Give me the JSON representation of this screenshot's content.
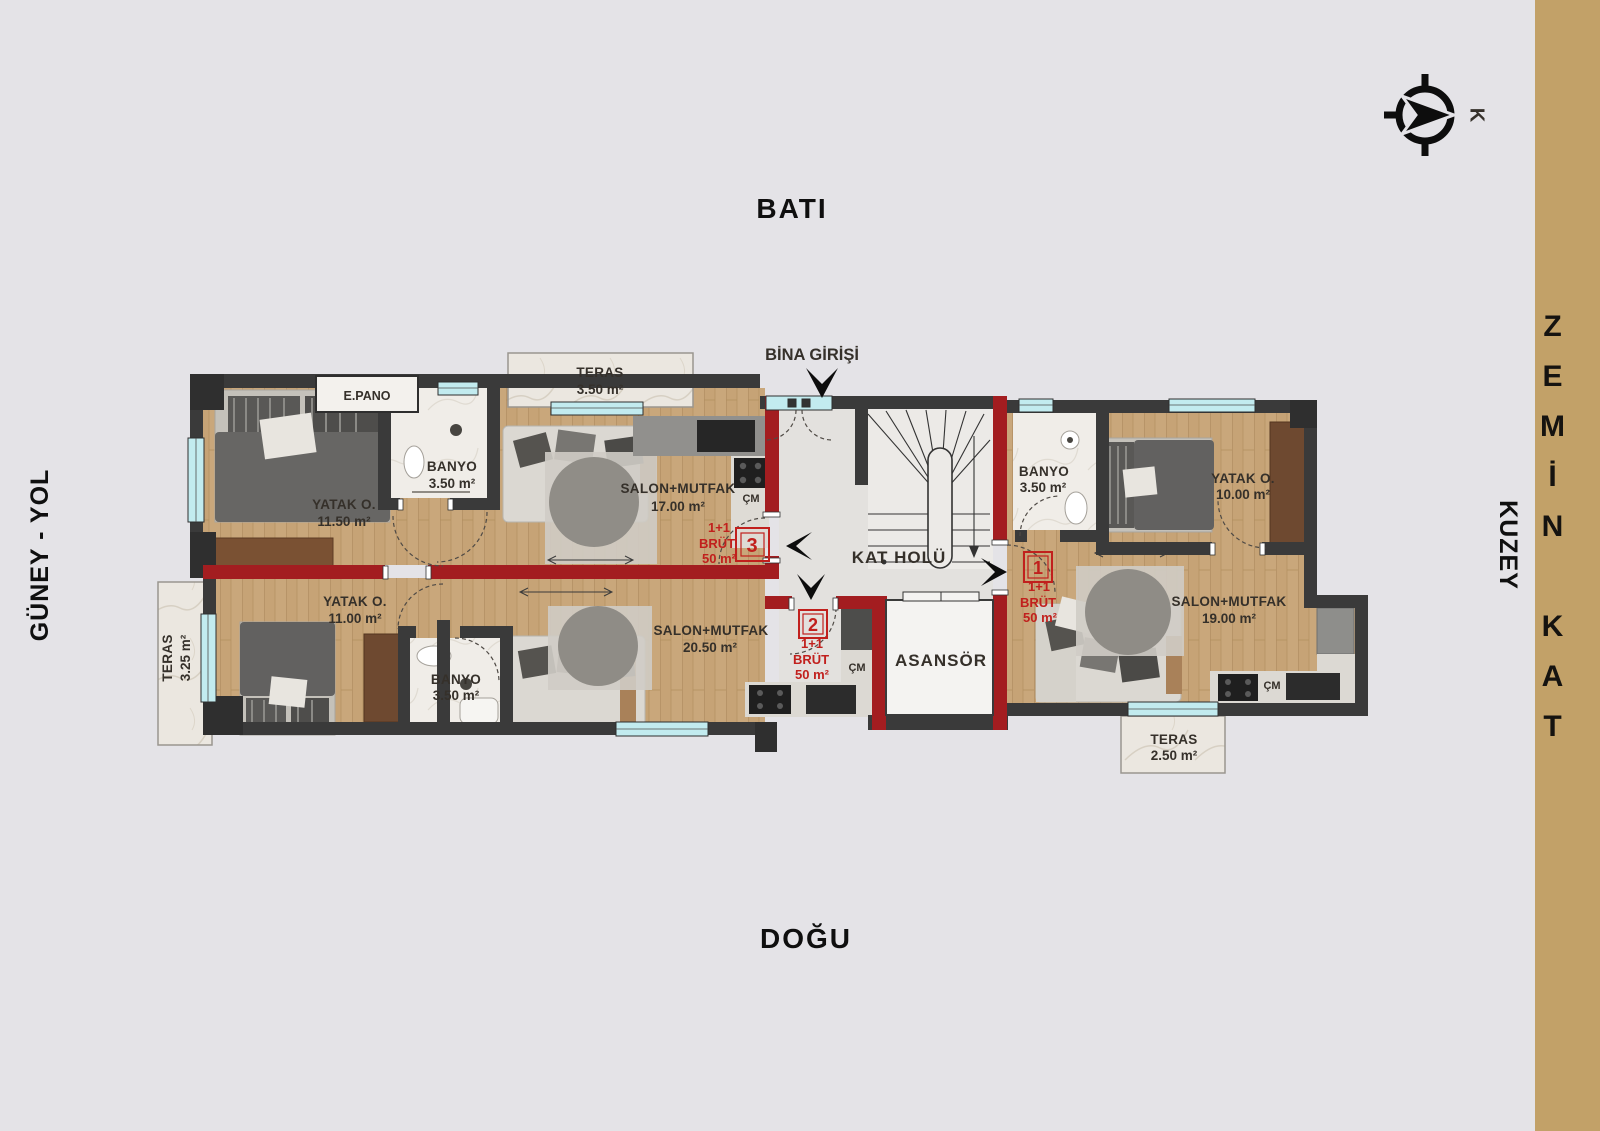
{
  "directions": {
    "west": "BATI",
    "east": "DOĞU",
    "south_road": "GÜNEY - YOL",
    "north": "KUZEY",
    "compass_letter": "K"
  },
  "floor_strip": {
    "label": "ZEMİN KAT"
  },
  "common": {
    "entrance": "BİNA GİRİŞİ",
    "hall": "KAT HOLÜ",
    "elevator": "ASANSÖR",
    "panel": "E.PANO"
  },
  "terraces": {
    "top": {
      "name": "TERAS",
      "area": "3.50 m²"
    },
    "left": {
      "name": "TERAS",
      "area": "3.25 m²"
    },
    "bottom_right": {
      "name": "TERAS",
      "area": "2.50 m²"
    }
  },
  "units": {
    "u1": {
      "number": "1",
      "type": "1+1",
      "brut": "BRÜT",
      "area": "50 m²",
      "cm": "ÇM",
      "banyo": {
        "name": "BANYO",
        "area": "3.50 m²"
      },
      "yatak": {
        "name": "YATAK O.",
        "area": "10.00 m²"
      },
      "salon": {
        "name": "SALON+MUTFAK",
        "area": "19.00 m²"
      }
    },
    "u2": {
      "number": "2",
      "type": "1+1",
      "brut": "BRÜT",
      "area": "50 m²",
      "cm": "ÇM",
      "banyo": {
        "name": "BANYO",
        "area": "3.50 m²"
      },
      "yatak": {
        "name": "YATAK O.",
        "area": "11.00 m²"
      },
      "salon": {
        "name": "SALON+MUTFAK",
        "area": "20.50 m²"
      }
    },
    "u3": {
      "number": "3",
      "type": "1+1",
      "brut": "BRÜT",
      "area": "50 m²",
      "cm": "ÇM",
      "banyo": {
        "name": "BANYO",
        "area": "3.50 m²"
      },
      "yatak": {
        "name": "YATAK O.",
        "area": "11.50 m²"
      },
      "salon": {
        "name": "SALON+MUTFAK",
        "area": "17.00 m²"
      }
    }
  },
  "colors": {
    "background": "#e4e3e7",
    "strip_gold": "#c2a168",
    "wall": "#3a3a3a",
    "unit_divider_red": "#a31d20",
    "badge_red": "#c1201d",
    "window_cyan": "#c2ebef",
    "wood_floor": "#c9a77b"
  }
}
